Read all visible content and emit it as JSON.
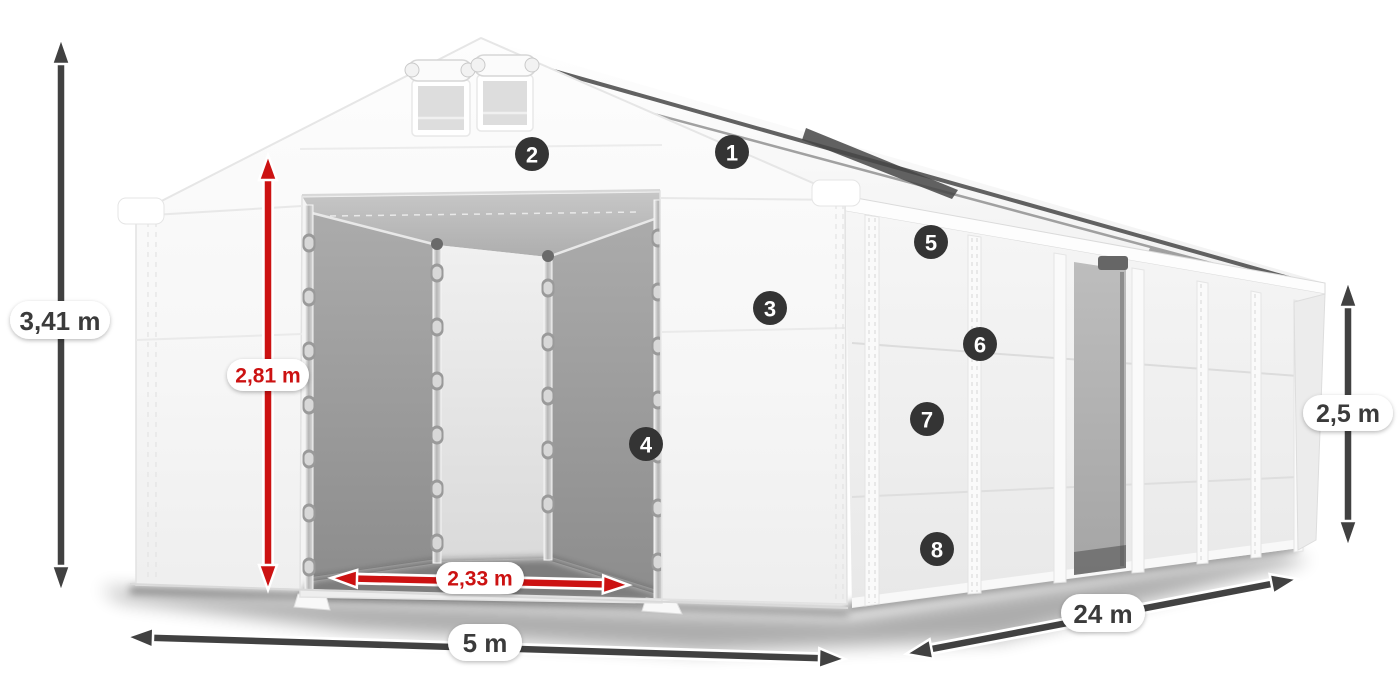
{
  "diagram": {
    "subject": "storage-tent-dimension-diagram",
    "units": "m",
    "colors": {
      "accent_red": "#cc1212",
      "dimension_dark": "#414141",
      "badge_dark": "#343434",
      "pill_white": "#ffffff",
      "tent_white": "#f7f7f7",
      "interior_gray": "#9b9b9b"
    },
    "dimensions": {
      "total_height": {
        "label": "3,41 m"
      },
      "door_height": {
        "label": "2,81 m"
      },
      "door_width": {
        "label": "2,33 m"
      },
      "width": {
        "label": "5 m"
      },
      "length": {
        "label": "24 m"
      },
      "side_height": {
        "label": "2,5 m"
      }
    },
    "callouts": [
      "1",
      "2",
      "3",
      "4",
      "5",
      "6",
      "7",
      "8"
    ]
  }
}
